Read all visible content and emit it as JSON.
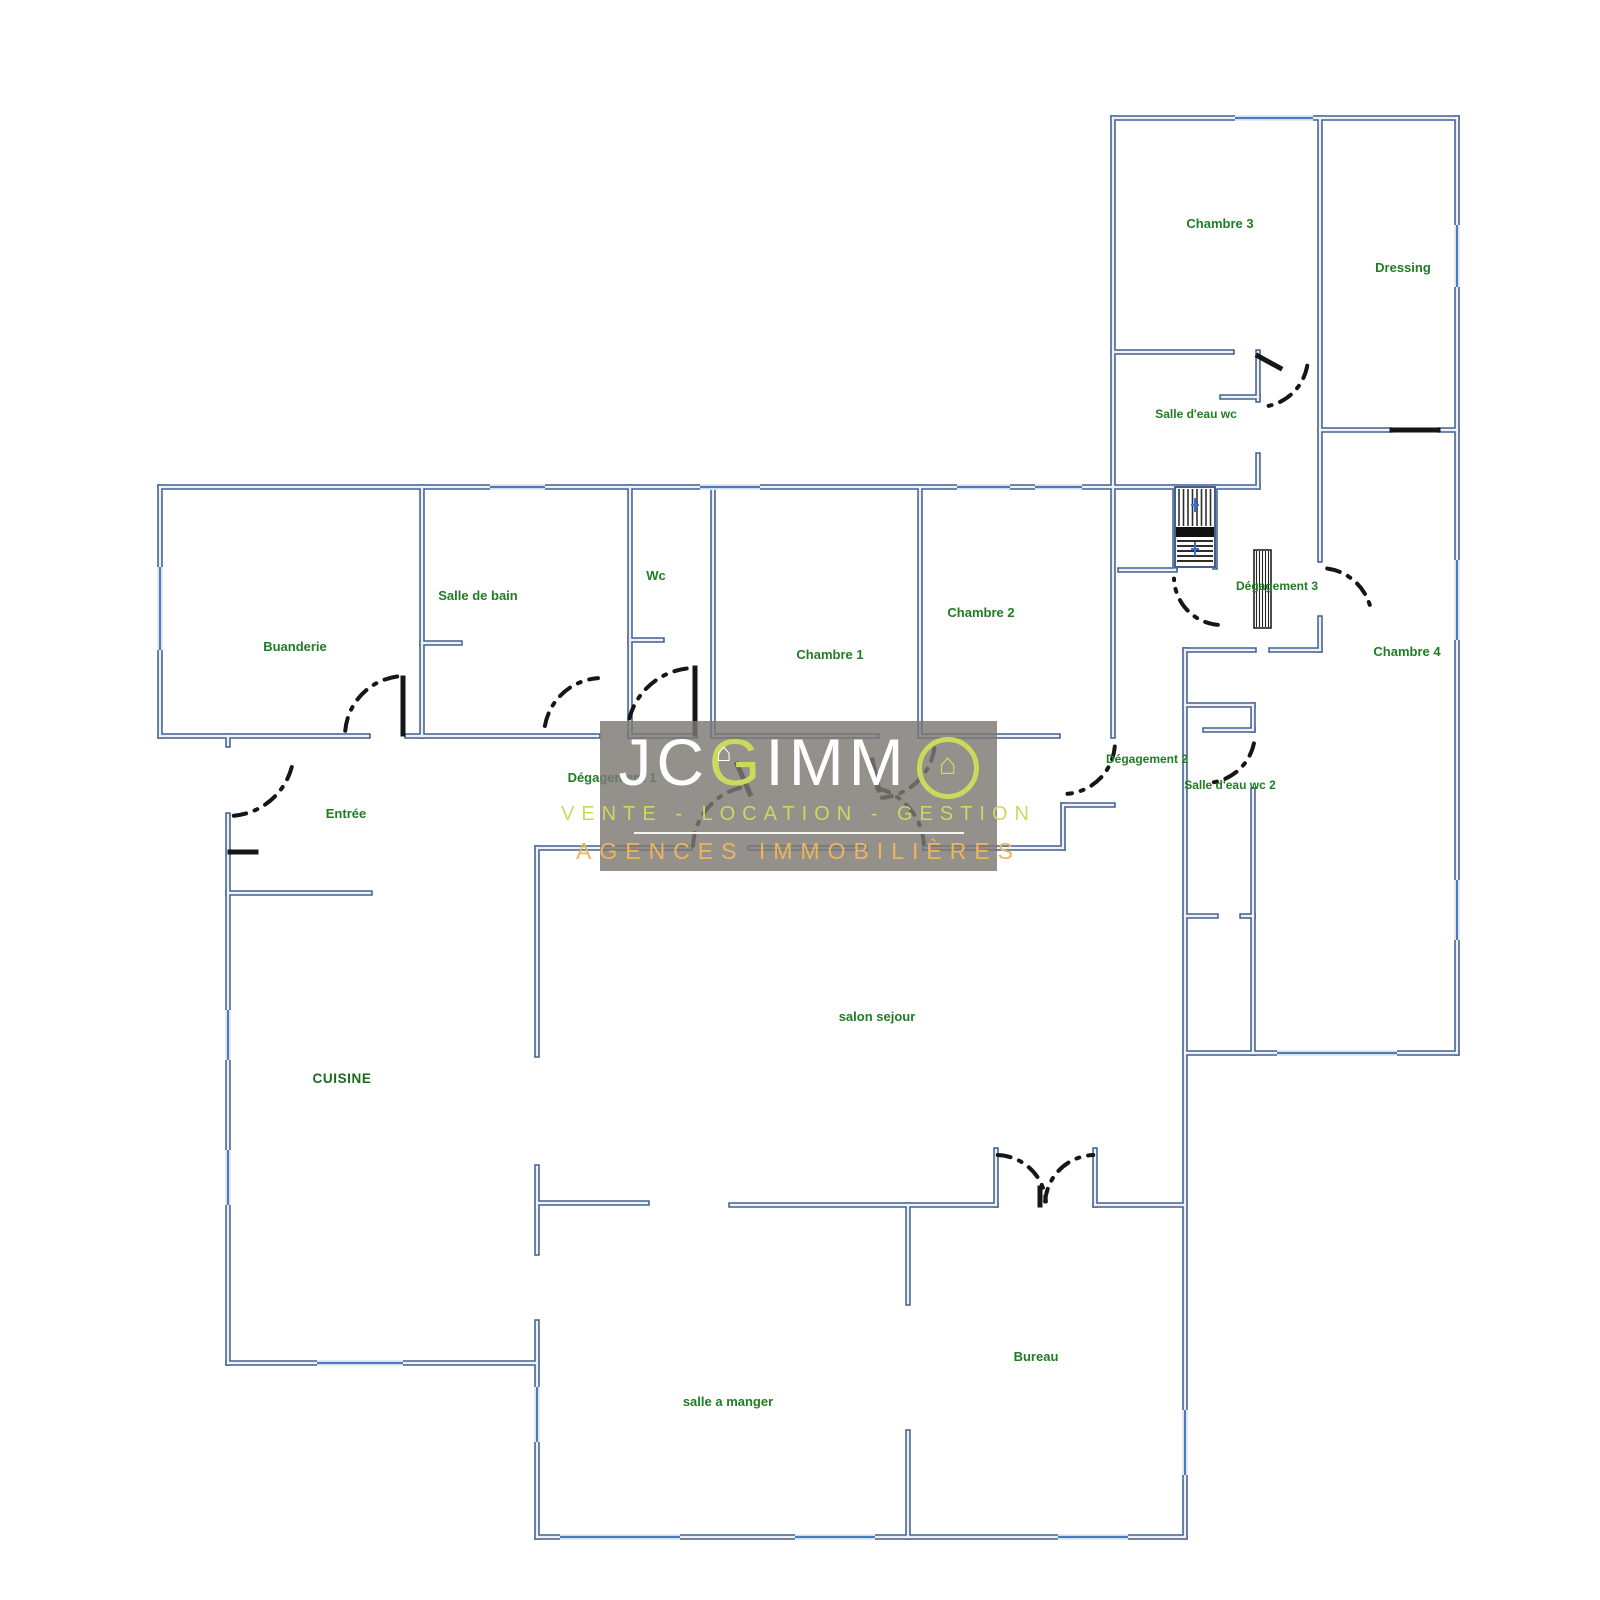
{
  "document": {
    "kind": "floor-plan-scan",
    "background": "#ffffff"
  },
  "watermark": {
    "brand_jc": "JC",
    "brand_g": "G",
    "brand_imm": "IMM",
    "brand_full": "JCGIMMO",
    "house_glyph": "⌂",
    "tagline": "VENTE - LOCATION - GESTION",
    "subtitle": "AGENCES IMMOBILIÈRES",
    "colors": {
      "panel": "rgba(124,121,116,0.82)",
      "letters": "#ffffff",
      "accent_green": "#ccd95c",
      "accent_orange": "#eeb45c",
      "rule": "#f5f5f0"
    },
    "box": {
      "x": 600,
      "y": 721,
      "w": 397,
      "h": 150
    }
  },
  "rooms": [
    {
      "name": "Chambre 3",
      "x": 1220,
      "y": 228,
      "cls": ""
    },
    {
      "name": "Dressing",
      "x": 1403,
      "y": 272,
      "cls": ""
    },
    {
      "name": "Salle d'eau wc",
      "x": 1196,
      "y": 418,
      "cls": "small"
    },
    {
      "name": "Buanderie",
      "x": 295,
      "y": 651,
      "cls": ""
    },
    {
      "name": "Salle de bain",
      "x": 478,
      "y": 600,
      "cls": ""
    },
    {
      "name": "Wc",
      "x": 656,
      "y": 580,
      "cls": ""
    },
    {
      "name": "Chambre 1",
      "x": 830,
      "y": 659,
      "cls": ""
    },
    {
      "name": "Chambre 2",
      "x": 981,
      "y": 617,
      "cls": ""
    },
    {
      "name": "Dégagement 3",
      "x": 1277,
      "y": 590,
      "cls": "small"
    },
    {
      "name": "Chambre 4",
      "x": 1407,
      "y": 656,
      "cls": ""
    },
    {
      "name": "Entrée",
      "x": 346,
      "y": 818,
      "cls": ""
    },
    {
      "name": "Dégagement 1",
      "x": 612,
      "y": 782,
      "cls": ""
    },
    {
      "name": "Dégagement 2",
      "x": 1147,
      "y": 763,
      "cls": "small"
    },
    {
      "name": "Salle d'eau wc 2",
      "x": 1230,
      "y": 789,
      "cls": "small"
    },
    {
      "name": "salon sejour",
      "x": 877,
      "y": 1021,
      "cls": ""
    },
    {
      "name": "CUISINE",
      "x": 342,
      "y": 1083,
      "cls": "caps"
    },
    {
      "name": "salle a manger",
      "x": 728,
      "y": 1406,
      "cls": ""
    },
    {
      "name": "Bureau",
      "x": 1036,
      "y": 1361,
      "cls": ""
    }
  ],
  "plan": {
    "colors": {
      "wall_outer": "#42608f",
      "wall_core": "#eef2f8",
      "window": "#4a7bbd",
      "door": "#161616",
      "stair": "#2e2e2e",
      "stair_mark": "#3a6fd8"
    },
    "walls": [
      [
        1113,
        118,
        1457,
        118
      ],
      [
        1457,
        118,
        1457,
        1053
      ],
      [
        1113,
        118,
        1113,
        736
      ],
      [
        1320,
        118,
        1320,
        560
      ],
      [
        1320,
        618,
        1320,
        650
      ],
      [
        1320,
        430,
        1390,
        430
      ],
      [
        1440,
        430,
        1457,
        430
      ],
      [
        1113,
        352,
        1232,
        352
      ],
      [
        1258,
        352,
        1258,
        400
      ],
      [
        1258,
        455,
        1258,
        487
      ],
      [
        1222,
        397,
        1258,
        397
      ],
      [
        160,
        487,
        1113,
        487
      ],
      [
        1113,
        487,
        1258,
        487
      ],
      [
        160,
        487,
        160,
        736
      ],
      [
        160,
        736,
        368,
        736
      ],
      [
        407,
        736,
        598,
        736
      ],
      [
        630,
        736,
        695,
        736
      ],
      [
        713,
        736,
        877,
        736
      ],
      [
        920,
        736,
        1058,
        736
      ],
      [
        422,
        487,
        422,
        736
      ],
      [
        422,
        643,
        460,
        643
      ],
      [
        630,
        487,
        630,
        736
      ],
      [
        630,
        640,
        662,
        640
      ],
      [
        713,
        487,
        713,
        736
      ],
      [
        920,
        487,
        920,
        736
      ],
      [
        1175,
        487,
        1175,
        567
      ],
      [
        1215,
        487,
        1215,
        567
      ],
      [
        1120,
        570,
        1175,
        570
      ],
      [
        1185,
        650,
        1254,
        650
      ],
      [
        1271,
        650,
        1320,
        650
      ],
      [
        1185,
        650,
        1185,
        1537
      ],
      [
        1185,
        705,
        1253,
        705
      ],
      [
        1253,
        705,
        1253,
        730
      ],
      [
        1253,
        790,
        1253,
        916
      ],
      [
        1205,
        730,
        1253,
        730
      ],
      [
        1185,
        916,
        1216,
        916
      ],
      [
        1242,
        916,
        1253,
        916
      ],
      [
        1253,
        916,
        1253,
        1053
      ],
      [
        1185,
        1053,
        1457,
        1053
      ],
      [
        537,
        848,
        690,
        848
      ],
      [
        750,
        848,
        865,
        848
      ],
      [
        925,
        848,
        1063,
        848
      ],
      [
        1063,
        805,
        1113,
        805
      ],
      [
        1063,
        805,
        1063,
        848
      ],
      [
        228,
        736,
        228,
        745
      ],
      [
        228,
        815,
        228,
        1363
      ],
      [
        228,
        893,
        370,
        893
      ],
      [
        228,
        1363,
        537,
        1363
      ],
      [
        537,
        1322,
        537,
        1537
      ],
      [
        537,
        1167,
        537,
        1253
      ],
      [
        537,
        848,
        537,
        1055
      ],
      [
        537,
        1203,
        647,
        1203
      ],
      [
        731,
        1205,
        996,
        1205
      ],
      [
        1095,
        1205,
        1185,
        1205
      ],
      [
        996,
        1150,
        996,
        1205
      ],
      [
        1095,
        1150,
        1095,
        1205
      ],
      [
        908,
        1205,
        908,
        1303
      ],
      [
        908,
        1432,
        908,
        1537
      ],
      [
        537,
        1537,
        1185,
        1537
      ]
    ],
    "windows": [
      [
        1235,
        118,
        1313,
        118
      ],
      [
        1457,
        225,
        1457,
        287
      ],
      [
        1457,
        560,
        1457,
        640
      ],
      [
        1457,
        880,
        1457,
        940
      ],
      [
        490,
        487,
        545,
        487
      ],
      [
        700,
        487,
        760,
        487
      ],
      [
        957,
        487,
        1010,
        487
      ],
      [
        1035,
        487,
        1082,
        487
      ],
      [
        160,
        567,
        160,
        650
      ],
      [
        228,
        1010,
        228,
        1060
      ],
      [
        228,
        1150,
        228,
        1205
      ],
      [
        317,
        1363,
        403,
        1363
      ],
      [
        537,
        1387,
        537,
        1442
      ],
      [
        560,
        1537,
        680,
        1537
      ],
      [
        795,
        1537,
        875,
        1537
      ],
      [
        1058,
        1537,
        1128,
        1537
      ],
      [
        1185,
        1410,
        1185,
        1475
      ],
      [
        1277,
        1053,
        1397,
        1053
      ]
    ],
    "doors": [
      {
        "cx": 405,
        "cy": 736,
        "r": 60,
        "a1": 185,
        "a2": 268
      },
      {
        "cx": 602,
        "cy": 736,
        "r": 58,
        "a1": 190,
        "a2": 266
      },
      {
        "cx": 695,
        "cy": 736,
        "r": 68,
        "a1": 195,
        "a2": 263
      },
      {
        "cx": 877,
        "cy": 740,
        "r": 58,
        "a1": 8,
        "a2": 85
      },
      {
        "cx": 1063,
        "cy": 742,
        "r": 52,
        "a1": 5,
        "a2": 85
      },
      {
        "cx": 228,
        "cy": 750,
        "r": 66,
        "a1": 15,
        "a2": 85
      },
      {
        "cx": 755,
        "cy": 848,
        "r": 62,
        "a1": 182,
        "a2": 256
      },
      {
        "cx": 862,
        "cy": 848,
        "r": 62,
        "a1": 284,
        "a2": 356
      },
      {
        "cx": 996,
        "cy": 1205,
        "r": 50,
        "a1": 272,
        "a2": 356
      },
      {
        "cx": 1095,
        "cy": 1205,
        "r": 50,
        "a1": 184,
        "a2": 268
      },
      {
        "cx": 1222,
        "cy": 577,
        "r": 48,
        "a1": 95,
        "a2": 178
      },
      {
        "cx": 1258,
        "cy": 357,
        "r": 50,
        "a1": 10,
        "a2": 78
      },
      {
        "cx": 1205,
        "cy": 733,
        "r": 50,
        "a1": 12,
        "a2": 82
      },
      {
        "cx": 1320,
        "cy": 620,
        "r": 52,
        "a1": 278,
        "a2": 350
      }
    ],
    "door_leaves": [
      [
        403,
        678,
        403,
        734
      ],
      [
        695,
        668,
        695,
        734
      ],
      [
        1392,
        430,
        1438,
        430
      ],
      [
        1258,
        356,
        1280,
        368
      ],
      [
        230,
        852,
        256,
        852
      ],
      [
        737,
        764,
        750,
        794
      ],
      [
        872,
        760,
        879,
        790
      ],
      [
        1040,
        1188,
        1040,
        1205
      ]
    ],
    "stairs": {
      "x": 1175,
      "y": 487,
      "w": 40,
      "h": 80,
      "mid_y": 527,
      "mid_h": 10
    },
    "hatch_door": {
      "x": 1254,
      "y": 550,
      "w": 17,
      "h": 78
    }
  }
}
